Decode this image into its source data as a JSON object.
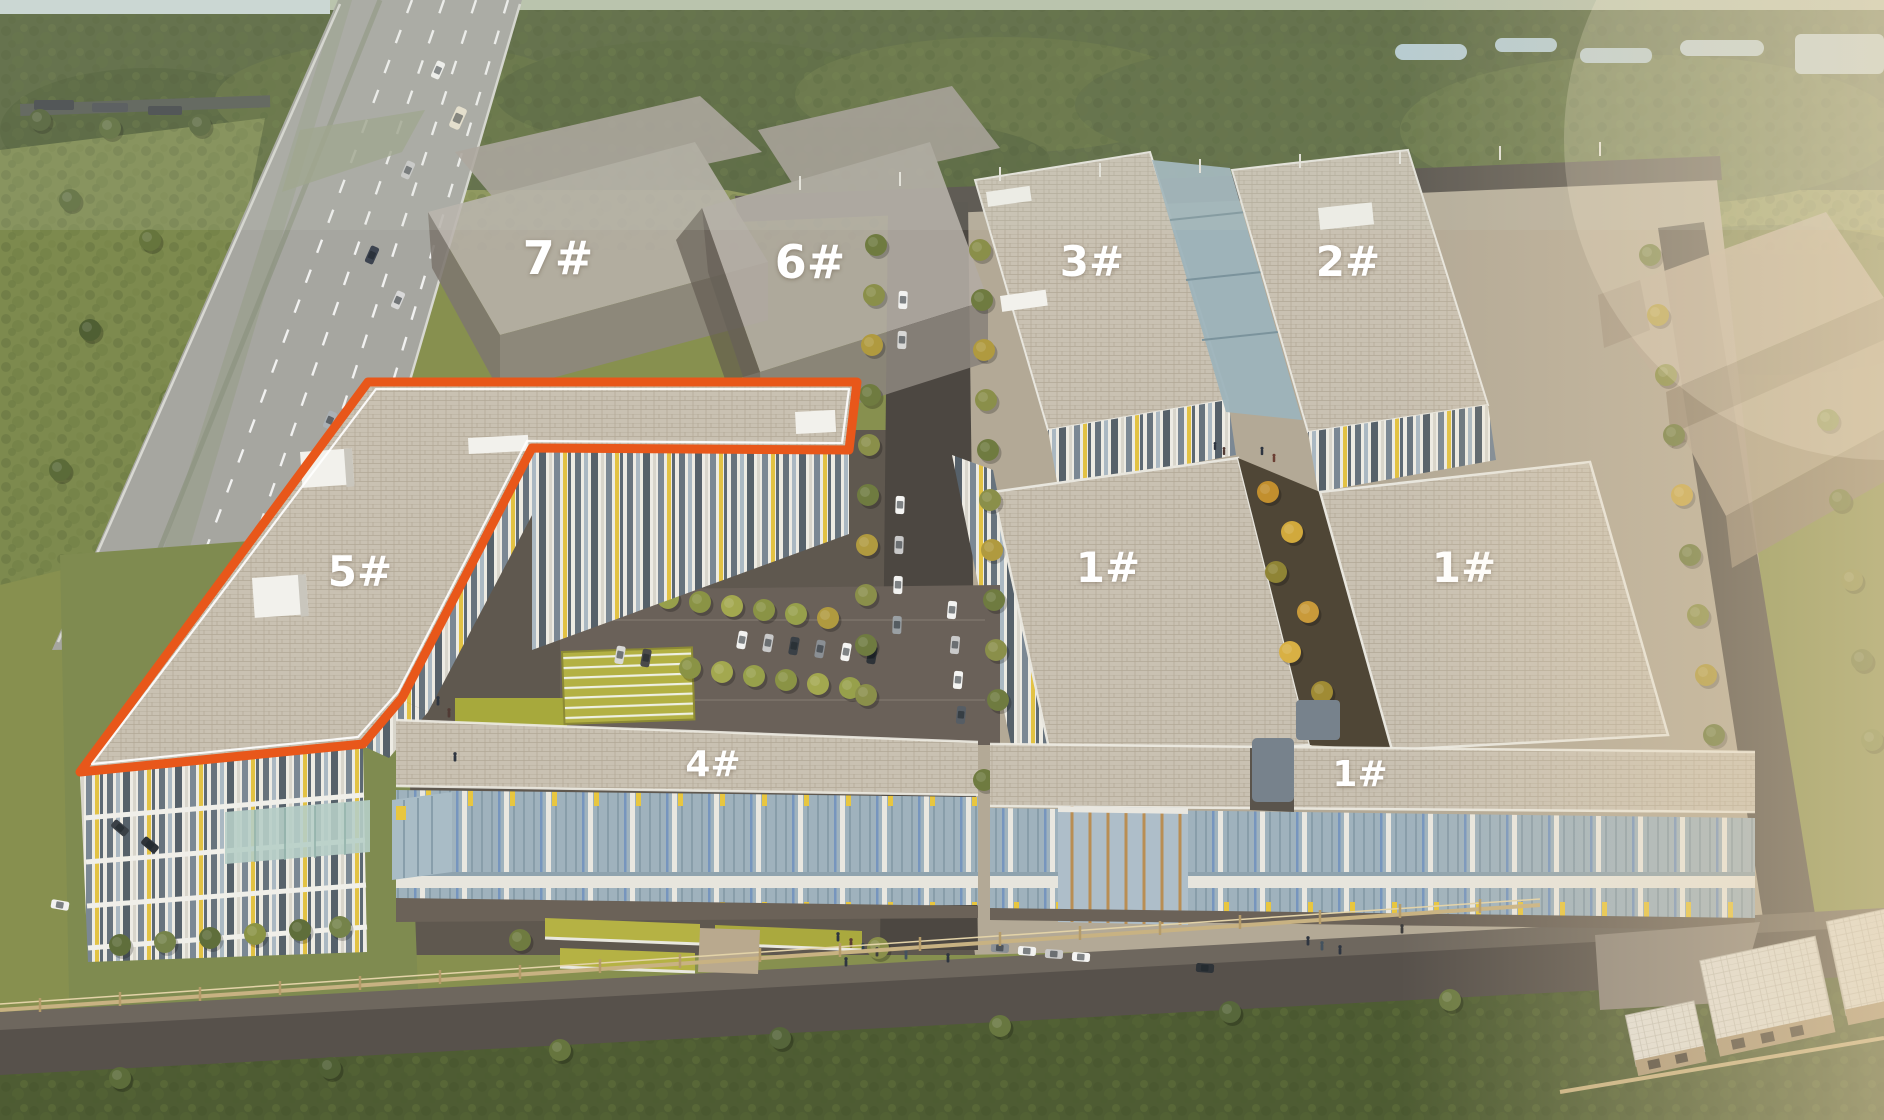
{
  "scene": {
    "highlight_color": "#E8571A",
    "label_color": "#FFFFFF"
  },
  "buildings": {
    "b7": {
      "label": "7#"
    },
    "b6": {
      "label": "6#"
    },
    "b3": {
      "label": "3#"
    },
    "b2": {
      "label": "2#"
    },
    "b5": {
      "label": "5#"
    },
    "b1_mid_west": {
      "label": "1#"
    },
    "b1_mid_east": {
      "label": "1#"
    },
    "b4": {
      "label": "4#"
    },
    "b1_south": {
      "label": "1#"
    }
  }
}
